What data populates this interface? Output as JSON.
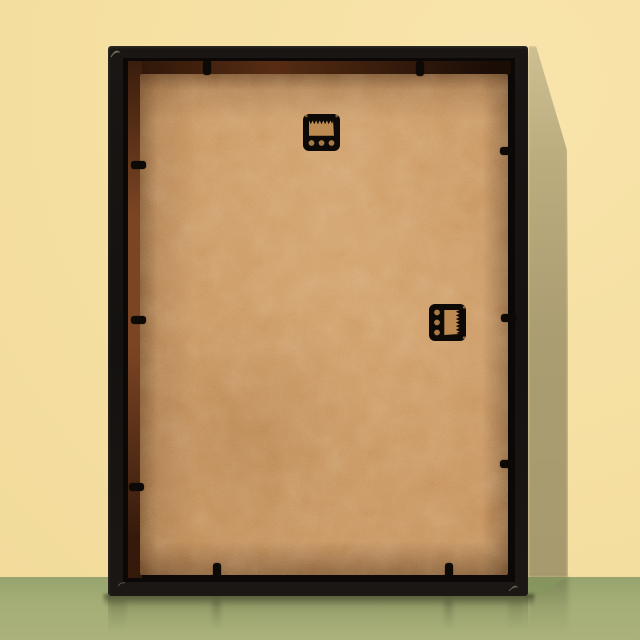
{
  "scene": {
    "alt": "Back of a black picture frame with tan MDF backing board, standing on a green glossy surface against a yellow wall",
    "width": 640,
    "height": 640,
    "floor_line_y": 577
  },
  "palette": {
    "wall": "#f5dfa1",
    "wall_shadow": "#ab9d72",
    "floor": "#abb27b",
    "floor_shadow": "#87975f",
    "frame": "#141110",
    "recess": "#0b0807",
    "rabbet": "#7b4524",
    "backing": "#c6925c",
    "hardware": "#0d0906",
    "cutout": "#bd8a52",
    "cutout_dark": "#a87a46",
    "scratch": "#d8cba6"
  },
  "frame": {
    "x": 108,
    "y": 46,
    "width": 420,
    "height": 550
  },
  "backing": {
    "x": 140,
    "y": 74,
    "width": 368,
    "height": 501
  },
  "hardware": {
    "hangers": [
      {
        "type": "sawtooth-hanger",
        "orientation": "horizontal",
        "x": 321.5,
        "y": 132.5,
        "rotation": 0
      },
      {
        "type": "sawtooth-hanger",
        "orientation": "vertical",
        "x": 447.5,
        "y": 322.5,
        "rotation": 90
      }
    ],
    "clips": [
      {
        "edge": "top",
        "cx": 207,
        "cy": 67
      },
      {
        "edge": "top",
        "cx": 420,
        "cy": 68
      },
      {
        "edge": "left",
        "cx": 138,
        "cy": 165
      },
      {
        "edge": "left",
        "cx": 138,
        "cy": 320
      },
      {
        "edge": "left",
        "cx": 136,
        "cy": 487
      },
      {
        "edge": "right",
        "cx": 507,
        "cy": 151
      },
      {
        "edge": "right",
        "cx": 508,
        "cy": 318
      },
      {
        "edge": "right",
        "cx": 507,
        "cy": 464
      },
      {
        "edge": "bottom",
        "cx": 217,
        "cy": 570
      },
      {
        "edge": "bottom",
        "cx": 449,
        "cy": 570
      }
    ]
  }
}
